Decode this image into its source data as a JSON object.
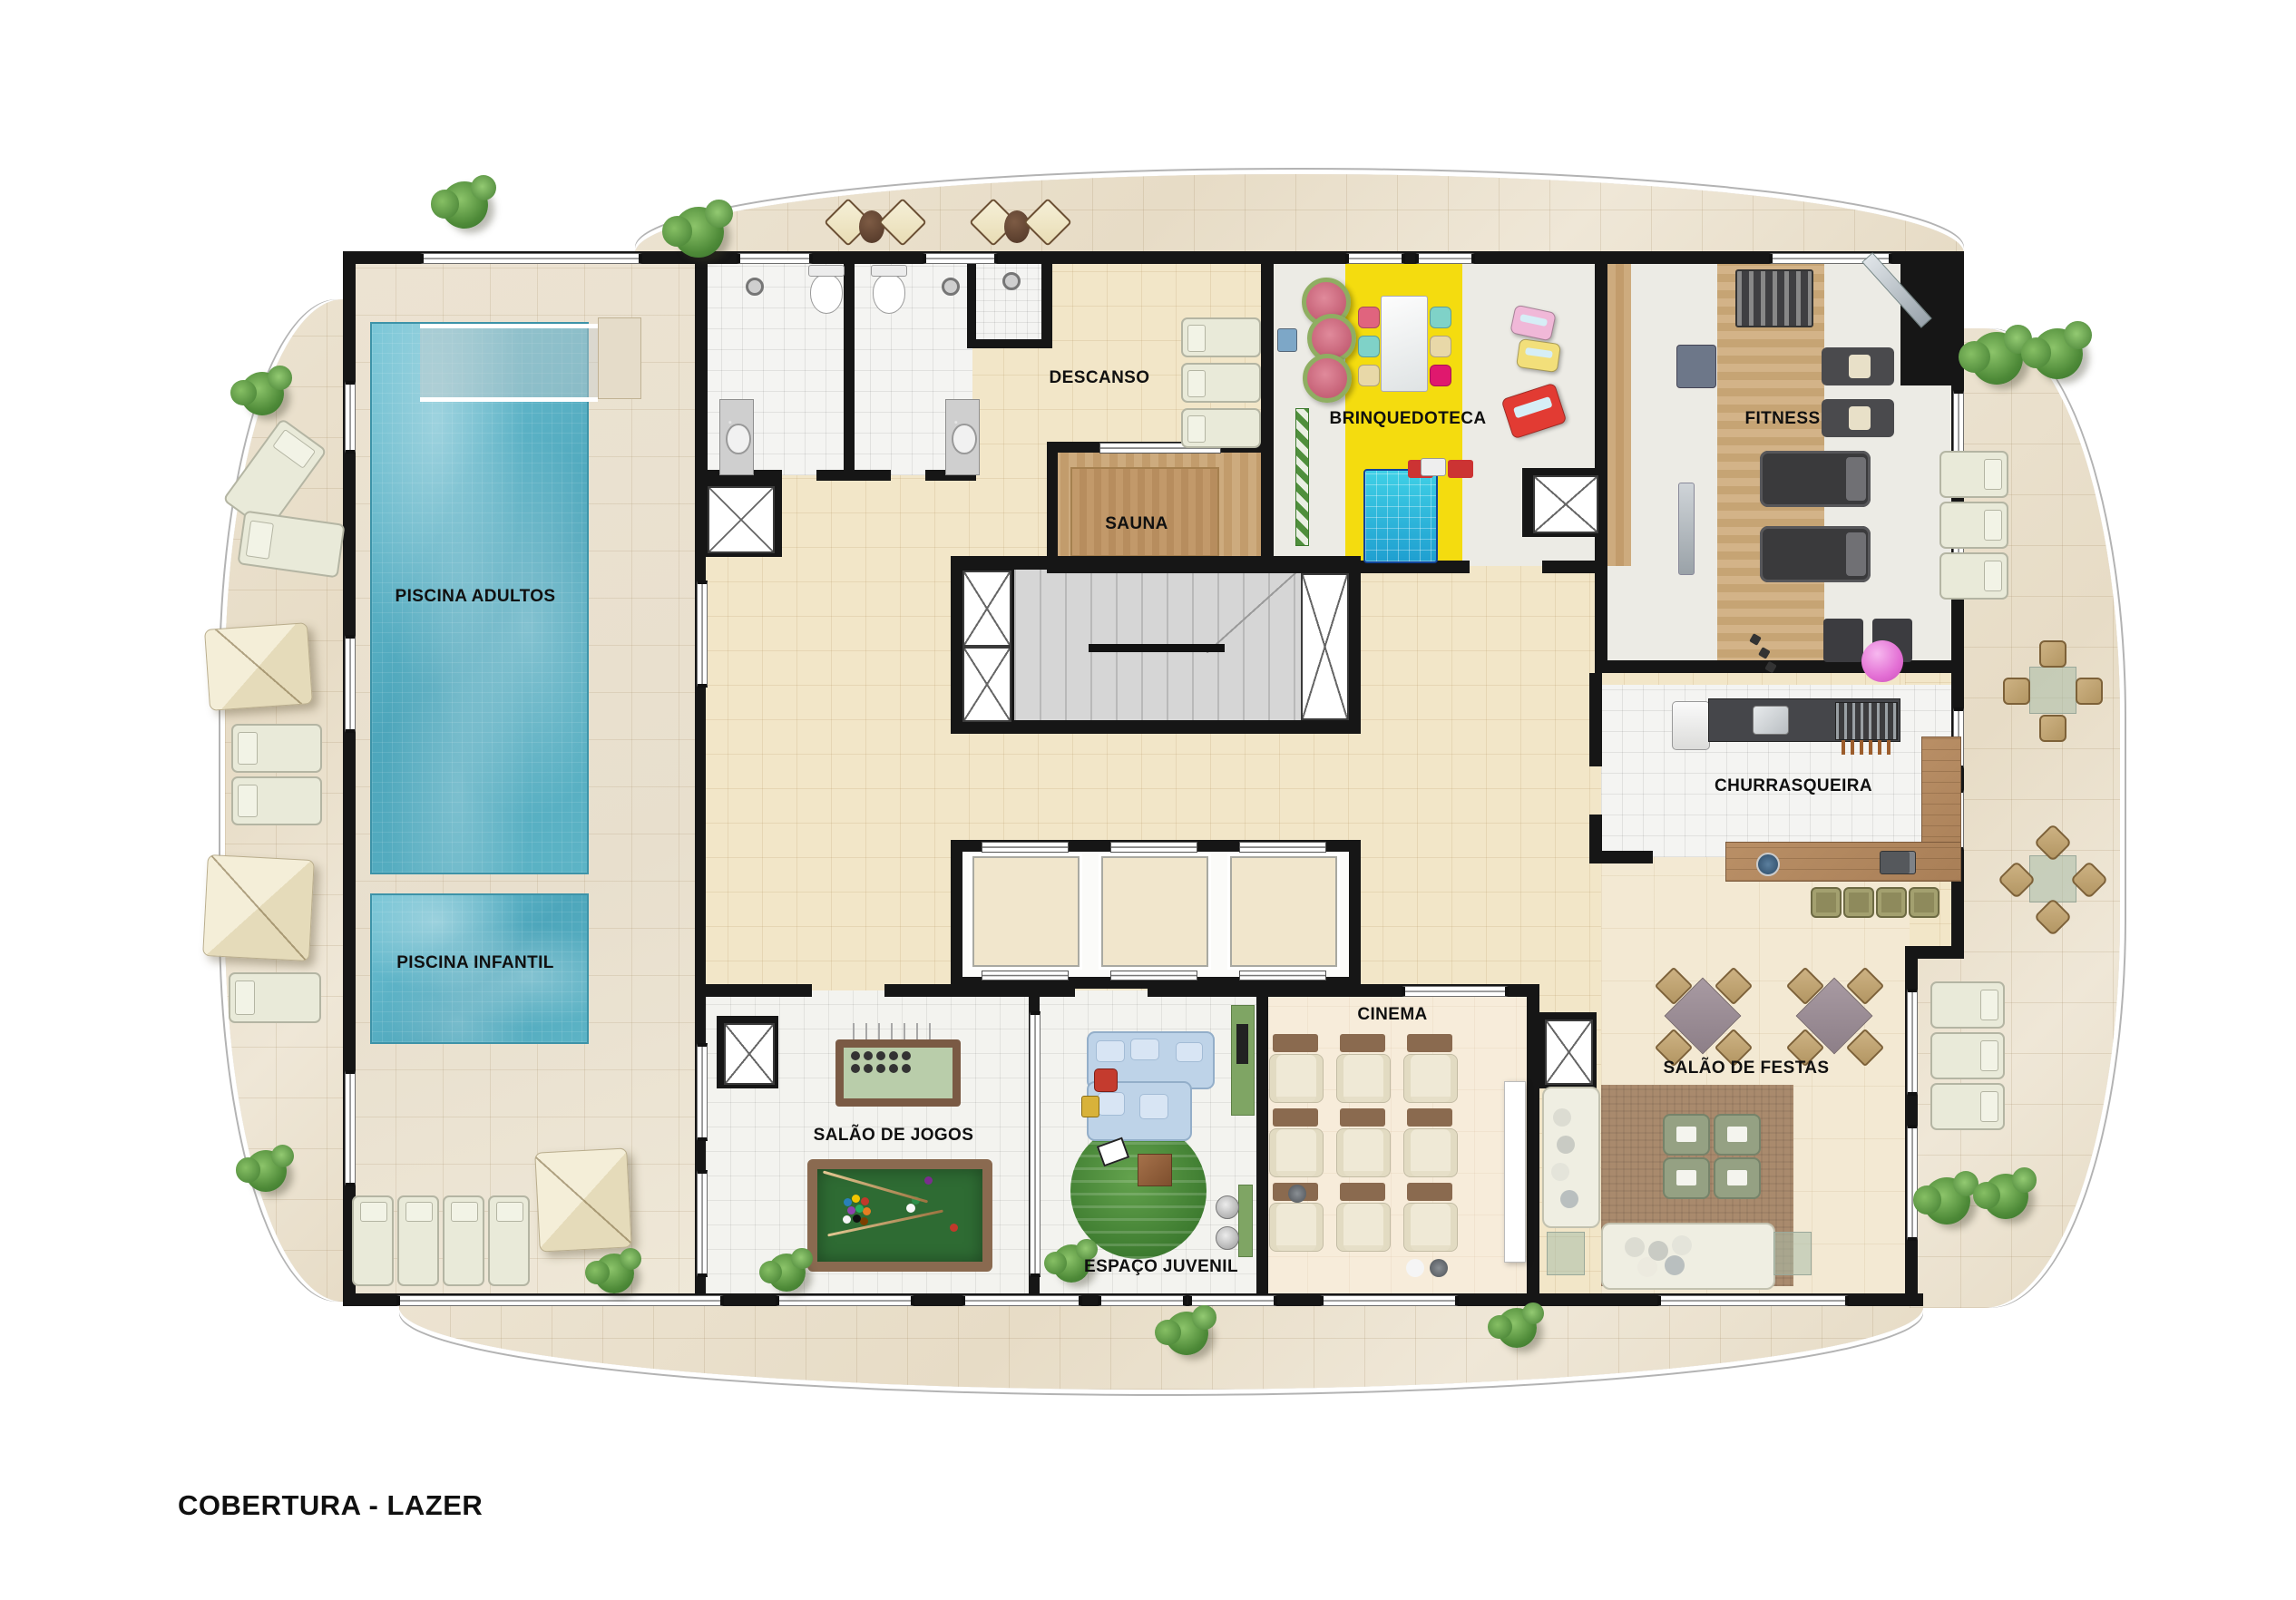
{
  "title": "COBERTURA - LAZER",
  "plan_type": "residential-leisure-rooftop-floor-plan",
  "rooms": {
    "piscina_adultos": {
      "label": "PISCINA ADULTOS"
    },
    "piscina_infantil": {
      "label": "PISCINA INFANTIL"
    },
    "descanso": {
      "label": "DESCANSO"
    },
    "sauna": {
      "label": "SAUNA"
    },
    "brinquedoteca": {
      "label": "BRINQUEDOTECA"
    },
    "fitness": {
      "label": "FITNESS"
    },
    "churrasqueira": {
      "label": "CHURRASQUEIRA"
    },
    "salao_de_festas": {
      "label": "SALÃO DE FESTAS"
    },
    "cinema": {
      "label": "CINEMA"
    },
    "espaco_juvenil": {
      "label": "ESPAÇO JUVENIL"
    },
    "salao_de_jogos": {
      "label": "SALÃO DE JOGOS"
    }
  },
  "colors": {
    "pool_water": "#55aec1",
    "playroom_accent_yellow": "#f4dc0f",
    "sauna_wood": "#c8a575",
    "gym_wood": "#cba97b",
    "wall_black": "#161616",
    "terrace_stone": "#e9dfcc",
    "interior_beige": "#f2e6c8",
    "pool_table_green": "#2e6b33",
    "youth_rug_green": "#4a8a3a",
    "cinema_seat_cream": "#efe9d6"
  }
}
